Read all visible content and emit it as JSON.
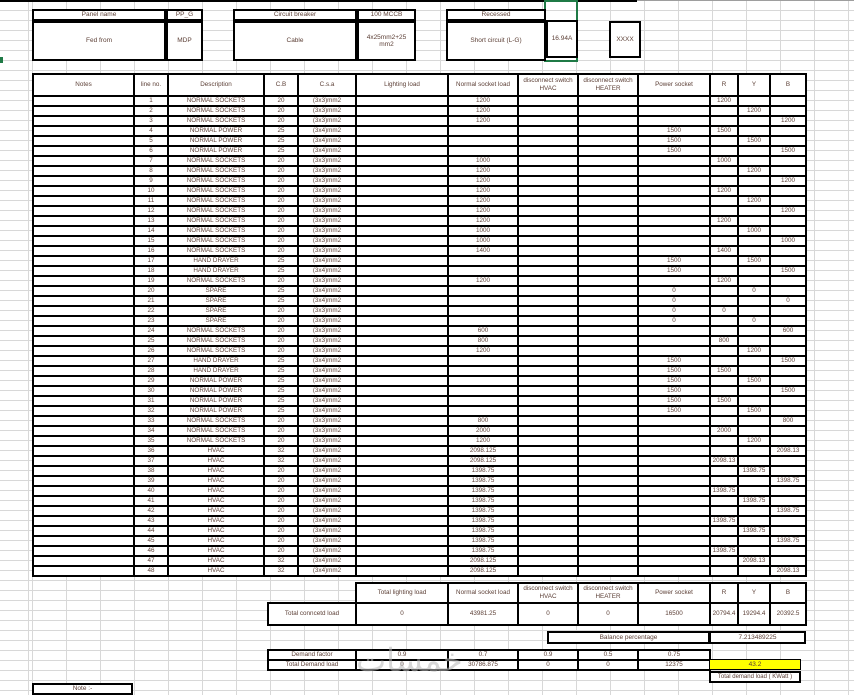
{
  "header_boxes": {
    "panel_name_label": "Panel name",
    "panel_name_value": "PP_G",
    "fed_from_label": "Fed from",
    "fed_from_value": "MDP",
    "circuit_breaker_label": "Circuit breaker",
    "circuit_breaker_value": "100 MCCB",
    "cable_label": "Cable",
    "cable_value": "4x25mm2+25mm2",
    "mounting_label": "Recessed",
    "short_circuit_label": "Short circuit (L-G)",
    "short_circuit_value": "16.94A",
    "spare_value": "XXXX"
  },
  "main_table": {
    "headers": [
      "Notes",
      "line no.",
      "Description",
      "C.B",
      "C.s.a",
      "Lighting load",
      "Normal socket load",
      "disconnect switch HVAC",
      "disconnect switch HEATER",
      "Power socket",
      "R",
      "Y",
      "B"
    ],
    "rows": [
      [
        1,
        "NORMAL SOCKETS",
        "20",
        "(3x3)mm2",
        "",
        "1200",
        "",
        "",
        "",
        "1200",
        "",
        ""
      ],
      [
        2,
        "NORMAL SOCKETS",
        "20",
        "(3x3)mm2",
        "",
        "1200",
        "",
        "",
        "",
        "",
        "1200",
        ""
      ],
      [
        3,
        "NORMAL SOCKETS",
        "20",
        "(3x3)mm2",
        "",
        "1200",
        "",
        "",
        "",
        "",
        "",
        "1200"
      ],
      [
        4,
        "NORMAL POWER",
        "25",
        "(3x4)mm2",
        "",
        "",
        "",
        "",
        "1500",
        "1500",
        "",
        ""
      ],
      [
        5,
        "NORMAL POWER",
        "25",
        "(3x4)mm2",
        "",
        "",
        "",
        "",
        "1500",
        "",
        "1500",
        ""
      ],
      [
        6,
        "NORMAL POWER",
        "25",
        "(3x4)mm2",
        "",
        "",
        "",
        "",
        "1500",
        "",
        "",
        "1500"
      ],
      [
        7,
        "NORMAL SOCKETS",
        "20",
        "(3x3)mm2",
        "",
        "1000",
        "",
        "",
        "",
        "1000",
        "",
        ""
      ],
      [
        8,
        "NORMAL SOCKETS",
        "20",
        "(3x3)mm2",
        "",
        "1200",
        "",
        "",
        "",
        "",
        "1200",
        ""
      ],
      [
        9,
        "NORMAL SOCKETS",
        "20",
        "(3x3)mm2",
        "",
        "1200",
        "",
        "",
        "",
        "",
        "",
        "1200"
      ],
      [
        10,
        "NORMAL SOCKETS",
        "20",
        "(3x3)mm2",
        "",
        "1200",
        "",
        "",
        "",
        "1200",
        "",
        ""
      ],
      [
        11,
        "NORMAL SOCKETS",
        "20",
        "(3x3)mm2",
        "",
        "1200",
        "",
        "",
        "",
        "",
        "1200",
        ""
      ],
      [
        12,
        "NORMAL SOCKETS",
        "20",
        "(3x3)mm2",
        "",
        "1200",
        "",
        "",
        "",
        "",
        "",
        "1200"
      ],
      [
        13,
        "NORMAL SOCKETS",
        "20",
        "(3x3)mm2",
        "",
        "1200",
        "",
        "",
        "",
        "1200",
        "",
        ""
      ],
      [
        14,
        "NORMAL SOCKETS",
        "20",
        "(3x3)mm2",
        "",
        "1000",
        "",
        "",
        "",
        "",
        "1000",
        ""
      ],
      [
        15,
        "NORMAL SOCKETS",
        "20",
        "(3x3)mm2",
        "",
        "1000",
        "",
        "",
        "",
        "",
        "",
        "1000"
      ],
      [
        16,
        "NORMAL SOCKETS",
        "20",
        "(3x3)mm2",
        "",
        "1400",
        "",
        "",
        "",
        "1400",
        "",
        ""
      ],
      [
        17,
        "HAND DRAYER",
        "25",
        "(3x4)mm2",
        "",
        "",
        "",
        "",
        "1500",
        "",
        "1500",
        ""
      ],
      [
        18,
        "HAND DRAYER",
        "25",
        "(3x4)mm2",
        "",
        "",
        "",
        "",
        "1500",
        "",
        "",
        "1500"
      ],
      [
        19,
        "NORMAL SOCKETS",
        "20",
        "(3x3)mm2",
        "",
        "1200",
        "",
        "",
        "",
        "1200",
        "",
        ""
      ],
      [
        20,
        "SPARE",
        "25",
        "(3x4)mm2",
        "",
        "",
        "",
        "",
        "0",
        "",
        "0",
        ""
      ],
      [
        21,
        "SPARE",
        "25",
        "(3x4)mm2",
        "",
        "",
        "",
        "",
        "0",
        "",
        "",
        "0"
      ],
      [
        22,
        "SPARE",
        "20",
        "(3x3)mm2",
        "",
        "",
        "",
        "",
        "0",
        "0",
        "",
        ""
      ],
      [
        23,
        "SPARE",
        "20",
        "(3x3)mm2",
        "",
        "",
        "",
        "",
        "0",
        "",
        "0",
        ""
      ],
      [
        24,
        "NORMAL SOCKETS",
        "20",
        "(3x3)mm2",
        "",
        "600",
        "",
        "",
        "",
        "",
        "",
        "600"
      ],
      [
        25,
        "NORMAL SOCKETS",
        "20",
        "(3x3)mm2",
        "",
        "800",
        "",
        "",
        "",
        "800",
        "",
        ""
      ],
      [
        26,
        "NORMAL SOCKETS",
        "20",
        "(3x3)mm2",
        "",
        "1200",
        "",
        "",
        "",
        "",
        "1200",
        ""
      ],
      [
        27,
        "HAND DRAYER",
        "25",
        "(3x4)mm2",
        "",
        "",
        "",
        "",
        "1500",
        "",
        "",
        "1500"
      ],
      [
        28,
        "HAND DRAYER",
        "25",
        "(3x4)mm2",
        "",
        "",
        "",
        "",
        "1500",
        "1500",
        "",
        ""
      ],
      [
        29,
        "NORMAL POWER",
        "25",
        "(3x4)mm2",
        "",
        "",
        "",
        "",
        "1500",
        "",
        "1500",
        ""
      ],
      [
        30,
        "NORMAL POWER",
        "25",
        "(3x4)mm2",
        "",
        "",
        "",
        "",
        "1500",
        "",
        "",
        "1500"
      ],
      [
        31,
        "NORMAL POWER",
        "25",
        "(3x4)mm2",
        "",
        "",
        "",
        "",
        "1500",
        "1500",
        "",
        ""
      ],
      [
        32,
        "NORMAL POWER",
        "25",
        "(3x4)mm2",
        "",
        "",
        "",
        "",
        "1500",
        "",
        "1500",
        ""
      ],
      [
        33,
        "NORMAL SOCKETS",
        "20",
        "(3x3)mm2",
        "",
        "800",
        "",
        "",
        "",
        "",
        "",
        "800"
      ],
      [
        34,
        "NORMAL SOCKETS",
        "20",
        "(3x3)mm2",
        "",
        "2000",
        "",
        "",
        "",
        "2000",
        "",
        ""
      ],
      [
        35,
        "NORMAL SOCKETS",
        "20",
        "(3x3)mm2",
        "",
        "1200",
        "",
        "",
        "",
        "",
        "1200",
        ""
      ],
      [
        36,
        "HVAC",
        "32",
        "(3x4)mm2",
        "",
        "2098.125",
        "",
        "",
        "",
        "",
        "",
        "2098.13"
      ],
      [
        37,
        "HVAC",
        "32",
        "(3x4)mm2",
        "",
        "2098.125",
        "",
        "",
        "",
        "2098.13",
        "",
        ""
      ],
      [
        38,
        "HVAC",
        "20",
        "(3x4)mm2",
        "",
        "1398.75",
        "",
        "",
        "",
        "",
        "1398.75",
        ""
      ],
      [
        39,
        "HVAC",
        "20",
        "(3x4)mm2",
        "",
        "1398.75",
        "",
        "",
        "",
        "",
        "",
        "1398.75"
      ],
      [
        40,
        "HVAC",
        "20",
        "(3x4)mm2",
        "",
        "1398.75",
        "",
        "",
        "",
        "1398.75",
        "",
        ""
      ],
      [
        41,
        "HVAC",
        "20",
        "(3x4)mm2",
        "",
        "1398.75",
        "",
        "",
        "",
        "",
        "1398.75",
        ""
      ],
      [
        42,
        "HVAC",
        "20",
        "(3x4)mm2",
        "",
        "1398.75",
        "",
        "",
        "",
        "",
        "",
        "1398.75"
      ],
      [
        43,
        "HVAC",
        "20",
        "(3x4)mm2",
        "",
        "1398.75",
        "",
        "",
        "",
        "1398.75",
        "",
        ""
      ],
      [
        44,
        "HVAC",
        "20",
        "(3x4)mm2",
        "",
        "1398.75",
        "",
        "",
        "",
        "",
        "1398.75",
        ""
      ],
      [
        45,
        "HVAC",
        "20",
        "(3x4)mm2",
        "",
        "1398.75",
        "",
        "",
        "",
        "",
        "",
        "1398.75"
      ],
      [
        46,
        "HVAC",
        "20",
        "(3x4)mm2",
        "",
        "1398.75",
        "",
        "",
        "",
        "1398.75",
        "",
        ""
      ],
      [
        47,
        "HVAC",
        "32",
        "(3x4)mm2",
        "",
        "2098.125",
        "",
        "",
        "",
        "",
        "2098.13",
        ""
      ],
      [
        48,
        "HVAC",
        "32",
        "(3x4)mm2",
        "",
        "2098.125",
        "",
        "",
        "",
        "",
        "",
        "2098.13"
      ]
    ]
  },
  "summary": {
    "headers": [
      "Total lighting load",
      "Normal socket load",
      "disconnect switch HVAC",
      "disconnect switch HEATER",
      "Power socket",
      "R",
      "Y",
      "B"
    ],
    "total_connected_label": "Total conncetd load",
    "total_connected": [
      "0",
      "43981.25",
      "0",
      "0",
      "16500",
      "20794.4",
      "19294.4",
      "20392.5"
    ],
    "balance_label": "Balance percentage",
    "balance_value": "7.213489225",
    "demand_factor_label": "Demand factor",
    "demand_factor": [
      "0.9",
      "0.7",
      "0.9",
      "0.5",
      "0.75"
    ],
    "total_demand_label": "Total Demand load",
    "total_demand": [
      "0",
      "30786.875",
      "0",
      "0",
      "12375"
    ],
    "total_demand_kw_value": "43.2",
    "total_demand_kw_label": "Total demand load  ( KWatt )"
  },
  "footer": {
    "note_label": "Note :-"
  },
  "watermark_text": "خمسات",
  "colors": {
    "highlight_yellow": "#ffff00",
    "selection_green": "#1f7a46",
    "gridline": "#d8d8d8",
    "text_ink": "#5d4037"
  }
}
